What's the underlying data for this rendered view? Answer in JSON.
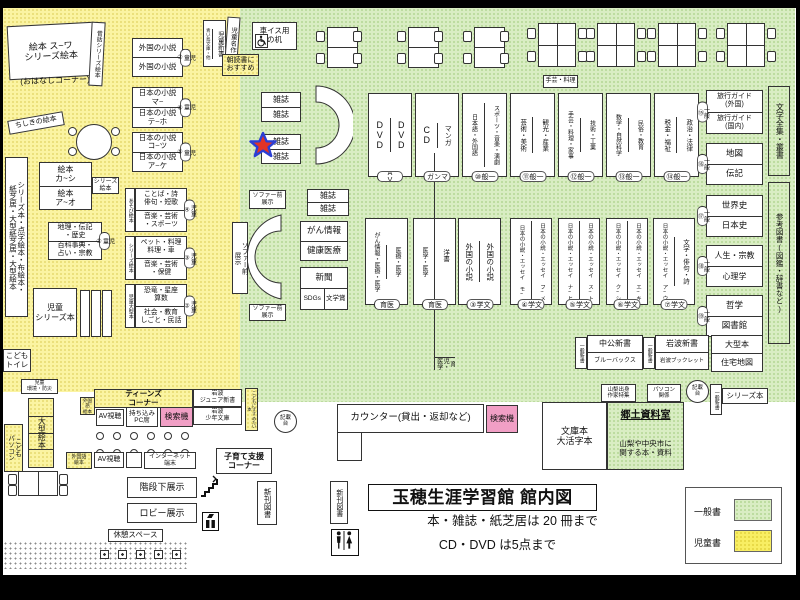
{
  "title": {
    "main": "玉穂生涯学習館 館内図",
    "rule1": "本・雑誌・紙芝居は 20 冊まで",
    "rule2": "CD・DVD は5点まで"
  },
  "legend": {
    "general": "一般書",
    "children": "児童書"
  },
  "k": {
    "ehon_series": "絵本 ス~ワ\nシリーズ絵本",
    "ohanashi": "(おはなしコーナー)",
    "mukashi": "昔話シリーズ絵本",
    "chishiki": "ちしきの絵本",
    "tall": "シリーズ本・点字絵本・布絵本・\n紙芝居・大型紙芝居・大型絵本",
    "ehon1": "絵本\nカ~シ",
    "ehon2": "絵本\nア~オ",
    "series_ehon": "シリーズ\n絵本",
    "chiri": "地理・伝記\n・歴史",
    "hyakka": "百科事典・\n占い・宗教",
    "kotoba": "ことば・詩\n俳句・短歌",
    "ongaku_sp": "音楽・芸術\n・スポーツ",
    "pet": "ペット・料理\n料理・車",
    "ongaku_ho": "音楽・芸術\n・保健",
    "kyoryu": "恐竜・星座\n算数",
    "shakai": "社会・教育\nしごと・民話",
    "asobi": "あそび絵本",
    "series_ehon_v": "シリーズ絵本",
    "ogata_v": "児童大型本",
    "jido_series": "児童\nシリーズ本",
    "gaikoku": "外国の小説",
    "nihon_ma": "日本の小説\nマ~",
    "nihon_te": "日本の小説\nテ~ホ",
    "nihon_ko": "日本の小説\nコ~ツ",
    "nihon_ake": "日本の小説\nア~ケ",
    "aoitori": "青い鳥文庫・他",
    "shinsho": "児童新書",
    "meisaku": "児童名作",
    "asadoku": "朝読書に\nおすすめ",
    "b1": "児童①",
    "b2": "児童②",
    "b3": "児童③",
    "b4": "児童④",
    "b5": "児童⑤",
    "b6": "児童⑥",
    "b7": "児童⑦"
  },
  "m": {
    "wheel_desk": "車イス用\nの机",
    "zasshi": "雑誌",
    "sofa_v": "ソファー前\n展示",
    "sofa_h": "ソファー前\n展示",
    "gan": "がん情報",
    "kenko": "健康医療",
    "shimbun": "新聞",
    "sdgs": "SDGs",
    "bungakusho": "文学賞"
  },
  "g": {
    "s1": [
      {
        "l": "DVD",
        "r": "DVD",
        "b": "AV"
      },
      {
        "l": "CD",
        "r": "マンガ",
        "b": "マンガ"
      },
      {
        "l": "日本語・外国語",
        "r": "スポーツ・音楽・演劇",
        "b": "一般⑩"
      },
      {
        "l": "芸術・美術",
        "r": "観光・産業",
        "b": "一般⑪"
      },
      {
        "l": "手芸・料理・家事",
        "r": "技術・工業",
        "b": "一般⑫"
      },
      {
        "l": "数学・自然科学",
        "r": "民俗・教育",
        "b": "一般⑬"
      },
      {
        "l": "税金・福祉",
        "r": "政治・法律",
        "b": "一般⑭"
      }
    ],
    "s2": [
      {
        "l": "がん情報・医療・医学",
        "r": "медицина",
        "b": "医育"
      },
      {
        "l": "医学・医学",
        "rt": "洋書",
        "rb": "育児・医学",
        "b": "医育"
      },
      {
        "l": "外国の小説",
        "r": "外国の小説",
        "b": "文学③"
      },
      {
        "l": "日本の小説・エッセイ モ~",
        "r": "日本の小説・エッセイ フ~メ",
        "b": "文学④"
      },
      {
        "l": "日本の小説・エッセイ ナ~ヒ",
        "r": "日本の小説・エッセイ ス~ト",
        "b": "文学⑤"
      },
      {
        "l": "日本の小説・エッセイ ク~シ",
        "r": "日本の小説・エッセイ エ~キ",
        "b": "文学⑥"
      },
      {
        "l": "日本の小説・エッセイ ア~ウ",
        "r": "文学・俳句・詩",
        "b": "文学⑦"
      }
    ],
    "rb": [
      {
        "t": "旅行ガイド\n(外国)",
        "u": "旅行ガイド\n(国内)",
        "b": "一般⑮"
      },
      {
        "t": "地図",
        "u": "伝記",
        "b": "一般⑯"
      },
      {
        "t": "世界史",
        "u": "日本史",
        "b": "一般⑰"
      },
      {
        "t": "人生・宗教",
        "u": "心理学",
        "b": "一般⑱"
      },
      {
        "t": "哲学",
        "u": "図書館",
        "b": "一般⑲"
      }
    ],
    "zenshu": "文学全集・叢書",
    "sanko": "参考図書(図鑑・辞書など)",
    "shugei": "手芸・料理",
    "counter": "カウンター(貸出・返却など)",
    "kensaku": "検索機",
    "kisai": "記載\n台",
    "chuko": "中公新書",
    "blue": "ブルーバックス",
    "iwanami": "岩波新書",
    "booklet": "岩波ブックレット",
    "shinsho_b": "一般新書",
    "ogata": "大型本",
    "jutaku": "住宅地図",
    "yamanashi": "山梨出身\n作家特集",
    "pasokon": "パソコン\n関係",
    "series_bon": "シリーズ本",
    "bunko": "文庫本\n大活字本",
    "kyodo": "郷土資料室",
    "kyodo_sub": "山梨や中央市に\n関する本・資料"
  },
  "b": {
    "toilet": "こども\nトイレ",
    "kankyo": "児童\n環境・防災",
    "ogata_ehon": "大型絵本",
    "kodomo_pc": "こども\nパソコン",
    "gaikokugo": "外国語\n絵本",
    "teens": "ティーンズ\nコーナー",
    "av": "AV視聴",
    "pc_seat": "持ち込み\nPC席",
    "iwanami_jr": "岩波\nジュニア新書",
    "iwanami_sh": "岩波\n少年文庫",
    "susume": "こどもにすすめたい本",
    "internet": "インターネット\n端末",
    "kosodate": "子育て支援\nコーナー",
    "kaidan": "階段下展示",
    "lobby": "ロビー展示",
    "kyukei": "休憩スペース",
    "shinkan": "新刊図書"
  }
}
